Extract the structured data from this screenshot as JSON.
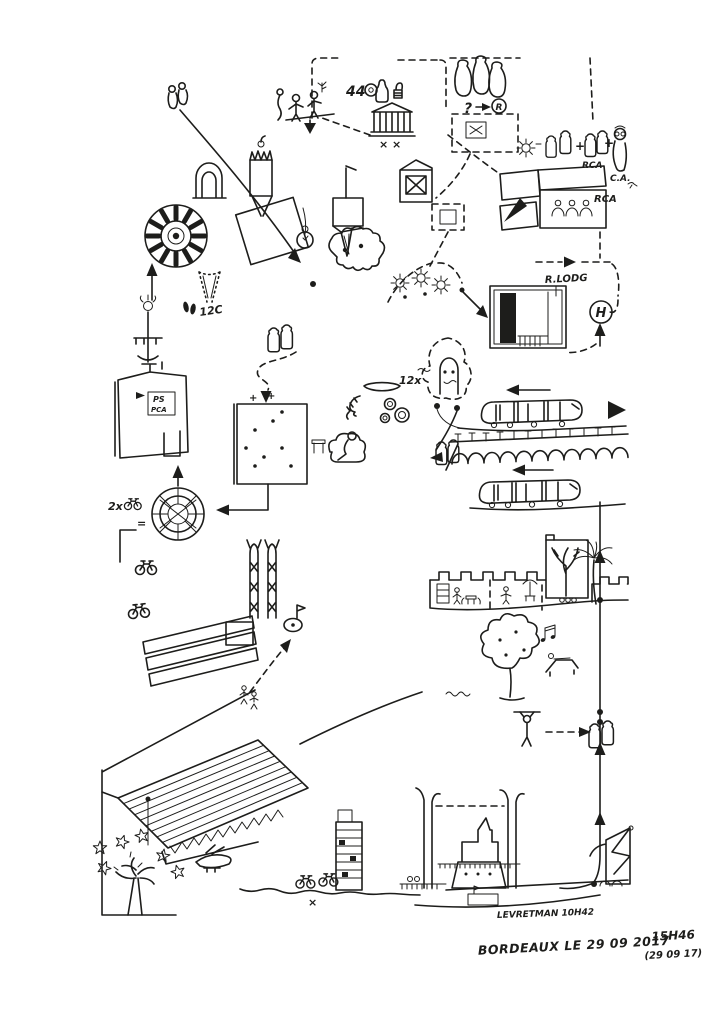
{
  "artwork": {
    "title": "Bordeaux urban sketch diary page",
    "paper_color": "#ffffff",
    "ink_color": "#1d1d1b",
    "signature": {
      "city_date": "BORDEAUX LE 29 09 2017",
      "time": "15H46",
      "date_alt": "(29 09 17)"
    },
    "labels": {
      "bridge_note": "LEVRETMAN 10H42",
      "price_top": "44",
      "question_mark": "?",
      "circled_r": "R",
      "rca_group": "RCA",
      "ca_person": "C.A.",
      "rca_building": "RCA",
      "rue_lodg": "R.LODG",
      "hotel_h": "H",
      "theatre_crosses": "× ×",
      "cone_note": "12C",
      "bikes_count": "2x",
      "equals": "=",
      "oysters_count": "12x",
      "sign_ps": "PS",
      "sign_pca": "PCA",
      "bike_cross": "×",
      "plus_1": "+",
      "plus_2": "+",
      "plus_3": "+",
      "plus_4": "+"
    },
    "scenes": [
      {
        "name": "strolling-pair",
        "desc": "two small figures, top left"
      },
      {
        "name": "stone-archway",
        "desc": "arched doorway"
      },
      {
        "name": "chandelier-column",
        "desc": "striped hanging column with candle crown"
      },
      {
        "name": "rose-window-wheel",
        "desc": "big segmented wheel with centre dot"
      },
      {
        "name": "tilted-lattice",
        "desc": "rotated grid window"
      },
      {
        "name": "scalloped-pastry",
        "desc": "scallop-edged blob with dots"
      },
      {
        "name": "dotted-ice-cream-cone",
        "desc": "cone noted 12C"
      },
      {
        "name": "lamp-fountain",
        "desc": "street lamp / drinking fountain"
      },
      {
        "name": "museum-entrance",
        "desc": "building with PS PCA sign"
      },
      {
        "name": "wine-bottle-figures",
        "desc": "pairs of jar-shaped people"
      },
      {
        "name": "waffle-facade",
        "desc": "dark gridded building with dots"
      },
      {
        "name": "reading-sofa",
        "desc": "person on a sofa with side table"
      },
      {
        "name": "oyster-platter",
        "desc": "dish, shells and shrimp noted 12x"
      },
      {
        "name": "canele-wheel",
        "desc": "spiral wheel equal to 2 bikes"
      },
      {
        "name": "bicycles",
        "desc": "several small bicycles"
      },
      {
        "name": "vine-trellis",
        "desc": "three hatched vine rows"
      },
      {
        "name": "twin-pylons",
        "desc": "two braced towers"
      },
      {
        "name": "golf-flag-green",
        "desc": "small oval with dot and flag"
      },
      {
        "name": "ridged-roof-hangar",
        "desc": "large corrugated slab in perspective"
      },
      {
        "name": "starred-tree",
        "desc": "tree figure surrounded by stars"
      },
      {
        "name": "seaplane",
        "desc": "small plane over the bank"
      },
      {
        "name": "tower-block",
        "desc": "tall slab building with floor lines"
      },
      {
        "name": "lift-bridge",
        "desc": "two pylons with dashed raised deck"
      },
      {
        "name": "cargo-ship",
        "desc": "ship passing the lift bridge"
      },
      {
        "name": "harbor-crane",
        "desc": "lattice crane on the quay"
      },
      {
        "name": "pull-up-figure",
        "desc": "person hanging from a bar"
      },
      {
        "name": "park-tree",
        "desc": "round tree with fruit dots"
      },
      {
        "name": "sun-lounger",
        "desc": "person on a deck chair with music notes"
      },
      {
        "name": "castle-wall-cafe",
        "desc": "crenellated wall with cafe vignettes"
      },
      {
        "name": "palm-tree",
        "desc": "palm by the wall"
      },
      {
        "name": "courtyard-tree-house",
        "desc": "house outline with tree inside"
      },
      {
        "name": "tram-upper",
        "desc": "tram heading left"
      },
      {
        "name": "pont-de-pierre",
        "desc": "arched bridge with lamp posts"
      },
      {
        "name": "tram-lower",
        "desc": "second tram heading left"
      },
      {
        "name": "ghost-tombstone",
        "desc": "dashed cloud with arched stone and eyes"
      },
      {
        "name": "sun-trio",
        "desc": "three sun symbols with dots"
      },
      {
        "name": "r-lodg-shop",
        "desc": "shopfront with dark shelf panel"
      },
      {
        "name": "hotel-h-marker",
        "desc": "circled H reached by dashed route"
      },
      {
        "name": "rca-house",
        "desc": "striped-roof house with three heads"
      },
      {
        "name": "friends-group",
        "desc": "bottle figures + pair RCA + person C.A."
      },
      {
        "name": "grand-theatre",
        "desc": "columned classical building with two crosses"
      },
      {
        "name": "gabled-house",
        "desc": "small house with X facade"
      },
      {
        "name": "hanging-bottles",
        "desc": "three hung bottles on dashed line"
      },
      {
        "name": "wine-price-note",
        "desc": "44, coin, bottle and thumbs-up"
      },
      {
        "name": "question-r-note",
        "desc": "? arrow circled R"
      },
      {
        "name": "pocket-watch",
        "desc": "hanging watch"
      },
      {
        "name": "machicolated-tower",
        "desc": "striped box over inverted cone"
      },
      {
        "name": "terrace-figures",
        "desc": "figures with plant on a platform"
      },
      {
        "name": "route-lines",
        "desc": "solid and dashed arrows linking all scenes"
      }
    ]
  }
}
